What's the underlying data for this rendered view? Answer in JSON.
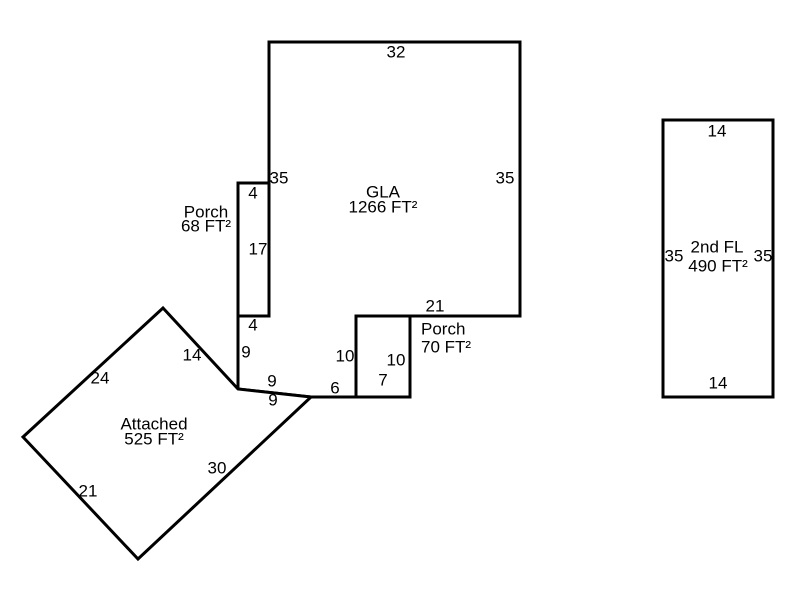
{
  "diagram": {
    "kind": "floor-plan-sketch",
    "background": "#ffffff",
    "stroke_color": "#000000",
    "text_color": "#000000",
    "stroke_width": 3,
    "font_size": 17,
    "shapes": [
      {
        "name": "gla-outline",
        "area_name": "GLA",
        "area_value": "1266 FT²",
        "points": "269,42 520,42 520,316 356,316 356,397 311,397 238,389 238,316 269,316"
      },
      {
        "name": "porch-68-outline",
        "area_name": "Porch",
        "area_value": "68 FT²",
        "points": "238,183 269,183 269,316 238,316"
      },
      {
        "name": "porch-70-outline",
        "area_name": "Porch",
        "area_value": "70 FT²",
        "points": "356,316 410,316 410,397 356,397"
      },
      {
        "name": "attached-outline",
        "area_name": "Attached",
        "area_value": "525 FT²",
        "points": "163,308 238,389 311,397 138,559 23,437"
      },
      {
        "name": "second-floor-outline",
        "area_name": "2nd FL",
        "area_value": "490 FT²",
        "points": "663,120 773,120 773,397 663,397"
      }
    ],
    "area_labels": [
      {
        "name": "gla-label",
        "anchor": "middle",
        "lines": [
          {
            "text": "GLA",
            "x": 383,
            "y": 192
          },
          {
            "text": "1266 FT²",
            "x": 383,
            "y": 207
          }
        ]
      },
      {
        "name": "porch-68-label",
        "anchor": "middle",
        "lines": [
          {
            "text": "Porch",
            "x": 206,
            "y": 212
          },
          {
            "text": "68 FT²",
            "x": 206,
            "y": 226
          }
        ]
      },
      {
        "name": "porch-70-label",
        "anchor": "start",
        "lines": [
          {
            "text": "Porch",
            "x": 421,
            "y": 329
          },
          {
            "text": "70 FT²",
            "x": 421,
            "y": 347
          }
        ]
      },
      {
        "name": "attached-label",
        "anchor": "middle",
        "lines": [
          {
            "text": "Attached",
            "x": 154,
            "y": 424
          },
          {
            "text": "525 FT²",
            "x": 154,
            "y": 439
          }
        ]
      },
      {
        "name": "second-floor-label",
        "anchor": "middle",
        "lines": [
          {
            "text": "2nd FL",
            "x": 717,
            "y": 247
          },
          {
            "text": "490 FT²",
            "x": 718,
            "y": 266
          }
        ]
      }
    ],
    "dimensions": [
      {
        "name": "dim-gla-top",
        "text": "32",
        "x": 396,
        "y": 52
      },
      {
        "name": "dim-gla-left",
        "text": "35",
        "x": 279,
        "y": 178
      },
      {
        "name": "dim-gla-right",
        "text": "35",
        "x": 505,
        "y": 178
      },
      {
        "name": "dim-gla-bottom",
        "text": "21",
        "x": 435,
        "y": 306
      },
      {
        "name": "dim-porch68-top",
        "text": "4",
        "x": 253,
        "y": 193
      },
      {
        "name": "dim-porch68-side",
        "text": "17",
        "x": 258,
        "y": 249
      },
      {
        "name": "dim-porch68-bottom",
        "text": "4",
        "x": 253,
        "y": 325
      },
      {
        "name": "dim-gla-notch-left",
        "text": "9",
        "x": 246,
        "y": 352
      },
      {
        "name": "dim-gla-notch-slope",
        "text": "9",
        "x": 272,
        "y": 381
      },
      {
        "name": "dim-attached-slope",
        "text": "9",
        "x": 273,
        "y": 400
      },
      {
        "name": "dim-gla-notch-bottom",
        "text": "6",
        "x": 335,
        "y": 388
      },
      {
        "name": "dim-porch70-left",
        "text": "10",
        "x": 345,
        "y": 356
      },
      {
        "name": "dim-porch70-right",
        "text": "10",
        "x": 396,
        "y": 360
      },
      {
        "name": "dim-porch70-bottom",
        "text": "7",
        "x": 383,
        "y": 380
      },
      {
        "name": "dim-attached-northeast",
        "text": "14",
        "x": 192,
        "y": 355
      },
      {
        "name": "dim-attached-northwest",
        "text": "24",
        "x": 100,
        "y": 378
      },
      {
        "name": "dim-attached-southwest",
        "text": "21",
        "x": 88,
        "y": 491
      },
      {
        "name": "dim-attached-southeast",
        "text": "30",
        "x": 217,
        "y": 468
      },
      {
        "name": "dim-2fl-top",
        "text": "14",
        "x": 717,
        "y": 131
      },
      {
        "name": "dim-2fl-left",
        "text": "35",
        "x": 674,
        "y": 256
      },
      {
        "name": "dim-2fl-right",
        "text": "35",
        "x": 763,
        "y": 256
      },
      {
        "name": "dim-2fl-bottom",
        "text": "14",
        "x": 718,
        "y": 383
      }
    ]
  }
}
